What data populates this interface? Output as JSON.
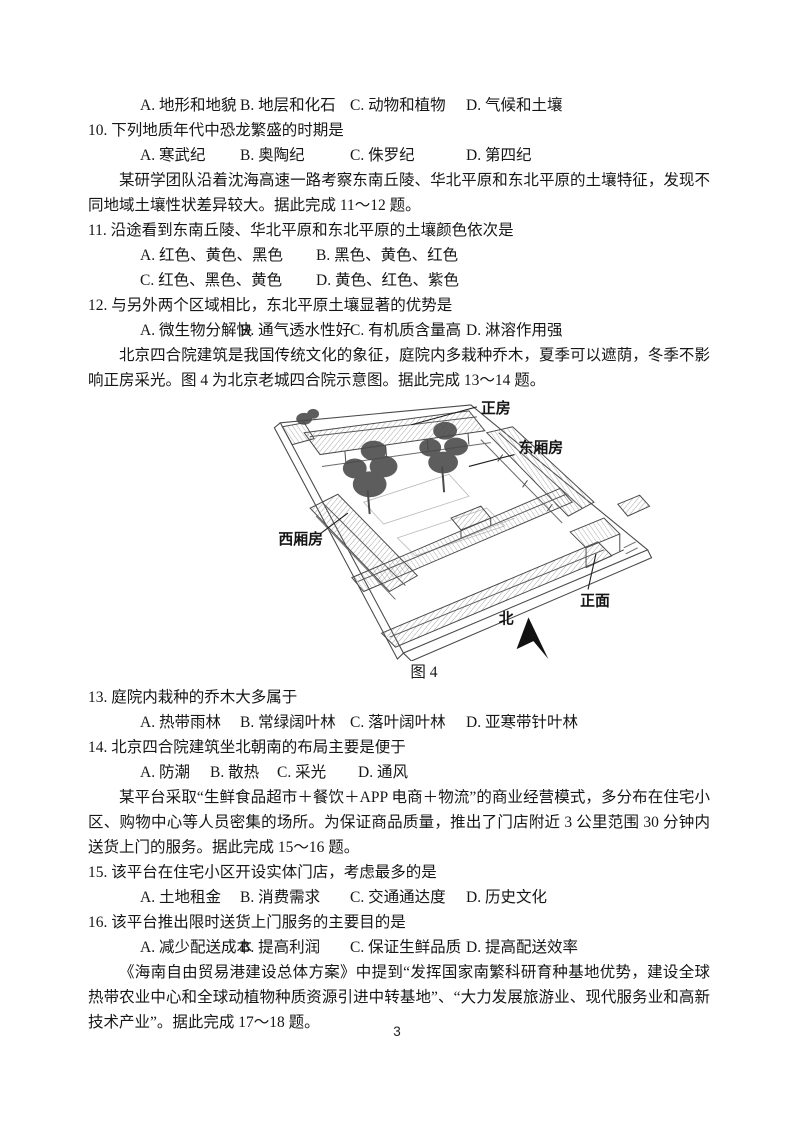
{
  "page": {
    "number": "3"
  },
  "figure": {
    "caption": "图 4",
    "labels": {
      "main_house": "正房",
      "east_wing": "东厢房",
      "west_wing": "西厢房",
      "front_facade": "正面",
      "north": "北"
    }
  },
  "content": [
    {
      "type": "options",
      "items": [
        "A. 地形和地貌",
        "B. 地层和化石",
        "C. 动物和植物",
        "D. 气候和土壤"
      ]
    },
    {
      "type": "question",
      "text": "10. 下列地质年代中恐龙繁盛的时期是"
    },
    {
      "type": "options",
      "items": [
        "A. 寒武纪",
        "B. 奥陶纪",
        "C. 侏罗纪",
        "D. 第四纪"
      ]
    },
    {
      "type": "para",
      "text": "某研学团队沿着沈海高速一路考察东南丘陵、华北平原和东北平原的土壤特征，发现不同地域土壤性状差异较大。据此完成 11～12 题。"
    },
    {
      "type": "question",
      "text": "11. 沿途看到东南丘陵、华北平原和东北平原的土壤颜色依次是"
    },
    {
      "type": "options",
      "items": [
        "A. 红色、黄色、黑色",
        "B. 黑色、黄色、红色"
      ]
    },
    {
      "type": "options",
      "items": [
        "C. 红色、黑色、黄色",
        "D. 黄色、红色、紫色"
      ]
    },
    {
      "type": "question",
      "text": "12. 与另外两个区域相比，东北平原土壤显著的优势是"
    },
    {
      "type": "options",
      "items": [
        "A. 微生物分解快",
        "B. 通气透水性好",
        "C. 有机质含量高",
        "D. 淋溶作用强"
      ]
    },
    {
      "type": "para",
      "text": "北京四合院建筑是我国传统文化的象征，庭院内多栽种乔木，夏季可以遮荫，冬季不影响正房采光。图 4 为北京老城四合院示意图。据此完成 13～14 题。"
    },
    {
      "type": "question",
      "text": "13. 庭院内栽种的乔木大多属于"
    },
    {
      "type": "options",
      "items": [
        "A. 热带雨林",
        "B. 常绿阔叶林",
        "C. 落叶阔叶林",
        "D. 亚寒带针叶林"
      ]
    },
    {
      "type": "question",
      "text": "14. 北京四合院建筑坐北朝南的布局主要是便于"
    },
    {
      "type": "options",
      "items": [
        "A. 防潮",
        "B. 散热",
        "C. 采光",
        "D. 通风"
      ]
    },
    {
      "type": "para",
      "text": "某平台采取“生鲜食品超市＋餐饮＋APP 电商＋物流”的商业经营模式，多分布在住宅小区、购物中心等人员密集的场所。为保证商品质量，推出了门店附近 3 公里范围 30 分钟内送货上门的服务。据此完成 15～16 题。"
    },
    {
      "type": "question",
      "text": "15. 该平台在住宅小区开设实体门店，考虑最多的是"
    },
    {
      "type": "options",
      "items": [
        "A. 土地租金",
        "B. 消费需求",
        "C. 交通通达度",
        "D. 历史文化"
      ]
    },
    {
      "type": "question",
      "text": "16. 该平台推出限时送货上门服务的主要目的是"
    },
    {
      "type": "options",
      "items": [
        "A. 减少配送成本",
        "B. 提高利润",
        "C. 保证生鲜品质",
        "D. 提高配送效率"
      ]
    },
    {
      "type": "para",
      "text": "《海南自由贸易港建设总体方案》中提到“发挥国家南繁科研育种基地优势，建设全球热带农业中心和全球动植物种质资源引进中转基地”、“大力发展旅游业、现代服务业和高新技术产业”。据此完成 17～18 题。"
    }
  ]
}
